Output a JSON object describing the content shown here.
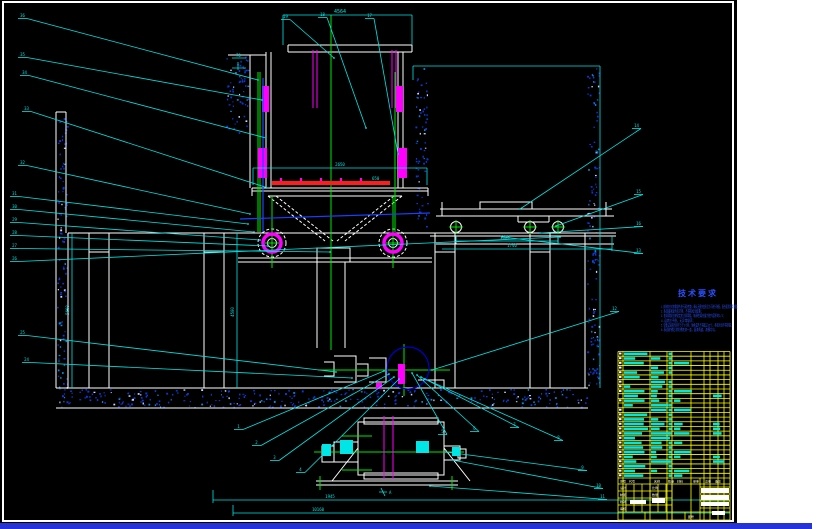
{
  "window": {
    "background": "#000000",
    "frame_color": "#ffffff",
    "margin_strip_color": "#ffffff",
    "bottom_bar_color": "#2633d8"
  },
  "palette": {
    "cyan": "#00e5e5",
    "green": "#00e800",
    "magenta": "#ff00ff",
    "red": "#ff1c1c",
    "yellow": "#ffff00",
    "hatch_blue": "#0a3ad4",
    "note_blue": "#2b50ff",
    "circle_blue": "#0000cc",
    "white": "#ffffff"
  },
  "dims": {
    "top": "4564",
    "trolley": "2650",
    "belt": "650",
    "side_a": "1125",
    "side_b": "1740",
    "bottom_a": "1945",
    "bottom_b": "10160",
    "pit_left": "5600",
    "pit_mid": "4500",
    "mini_a": "70",
    "section": "A"
  },
  "notes": {
    "title": "技术要求",
    "lines": [
      "1.安装前应对各零部件进行清洗检查，确认无损伤变形后方可进行装配，配合面涂润滑油脂；",
      "2.各连接紧固件应拧紧，不得有松动现象；",
      "3.各润滑部位按规定加注润滑脂，轴承腔填充量为腔内容积的2/3；",
      "4.运转应平稳，无异常噪声；",
      "5.空载试运转时间不少于2小时，轴承温升不得超过35℃，各密封处不得渗漏；",
      "6.表面除锈后涂防锈底漆一道，面漆两道，漆膜均匀。"
    ],
    "line_lengths": [
      78,
      42,
      64,
      34,
      72,
      56
    ]
  },
  "callouts": [
    {
      "n": "19",
      "lx": 283,
      "ly": 17,
      "tx": 334,
      "ty": 58
    },
    {
      "n": "18",
      "lx": 320,
      "ly": 15,
      "tx": 366,
      "ty": 128
    },
    {
      "n": "17",
      "lx": 367,
      "ly": 16,
      "tx": 398,
      "ty": 154
    },
    {
      "n": "36",
      "lx": 20,
      "ly": 16,
      "tx": 258,
      "ty": 80
    },
    {
      "n": "35",
      "lx": 20,
      "ly": 55,
      "tx": 262,
      "ty": 100
    },
    {
      "n": "34",
      "lx": 22,
      "ly": 73,
      "tx": 266,
      "ty": 138
    },
    {
      "n": "33",
      "lx": 24,
      "ly": 109,
      "tx": 268,
      "ty": 188
    },
    {
      "n": "32",
      "lx": 20,
      "ly": 163,
      "tx": 250,
      "ty": 214
    },
    {
      "n": "31",
      "lx": 12,
      "ly": 194,
      "tx": 248,
      "ty": 224
    },
    {
      "n": "30",
      "lx": 12,
      "ly": 207,
      "tx": 254,
      "ty": 232
    },
    {
      "n": "29",
      "lx": 12,
      "ly": 220,
      "tx": 260,
      "ty": 240
    },
    {
      "n": "28",
      "lx": 12,
      "ly": 233,
      "tx": 268,
      "ty": 246
    },
    {
      "n": "27",
      "lx": 12,
      "ly": 246,
      "tx": 330,
      "ty": 252
    },
    {
      "n": "26",
      "lx": 12,
      "ly": 259,
      "tx": 560,
      "ty": 237
    },
    {
      "n": "25",
      "lx": 20,
      "ly": 333,
      "tx": 336,
      "ty": 372
    },
    {
      "n": "24",
      "lx": 24,
      "ly": 360,
      "tx": 352,
      "ty": 378
    },
    {
      "n": "14",
      "lx": 634,
      "ly": 126,
      "tx": 520,
      "ty": 209
    },
    {
      "n": "15",
      "lx": 636,
      "ly": 192,
      "tx": 556,
      "ty": 226
    },
    {
      "n": "16",
      "lx": 636,
      "ly": 224,
      "tx": 540,
      "ty": 233
    },
    {
      "n": "13",
      "lx": 636,
      "ly": 251,
      "tx": 502,
      "ty": 237
    },
    {
      "n": "12",
      "lx": 612,
      "ly": 309,
      "tx": 432,
      "ty": 370
    },
    {
      "n": "1",
      "lx": 236,
      "ly": 427,
      "tx": 384,
      "ty": 371
    },
    {
      "n": "2",
      "lx": 254,
      "ly": 443,
      "tx": 389,
      "ty": 374
    },
    {
      "n": "3",
      "lx": 272,
      "ly": 458,
      "tx": 394,
      "ty": 377
    },
    {
      "n": "4",
      "lx": 298,
      "ly": 470,
      "tx": 399,
      "ty": 379
    },
    {
      "n": "5",
      "lx": 440,
      "ly": 432,
      "tx": 412,
      "ty": 373
    },
    {
      "n": "6",
      "lx": 472,
      "ly": 429,
      "tx": 417,
      "ty": 375
    },
    {
      "n": "7",
      "lx": 512,
      "ly": 425,
      "tx": 421,
      "ty": 377
    },
    {
      "n": "8",
      "lx": 556,
      "ly": 438,
      "tx": 425,
      "ty": 379
    },
    {
      "n": "9",
      "lx": 580,
      "ly": 468,
      "tx": 446,
      "ty": 452
    },
    {
      "n": "10",
      "lx": 596,
      "ly": 486,
      "tx": 452,
      "ty": 460
    },
    {
      "n": "11",
      "lx": 600,
      "ly": 497,
      "tx": 430,
      "ty": 486
    }
  ],
  "bom": {
    "rows": 27,
    "header": [
      "序号",
      "代号",
      "名称",
      "数量",
      "材料",
      "单重",
      "总重",
      "备注"
    ],
    "header_xs": [
      620,
      629,
      654,
      668,
      677,
      693,
      705,
      715
    ]
  },
  "title_block": {
    "labels": [
      {
        "t": "设计",
        "x": 620,
        "y": 489
      },
      {
        "t": "制图",
        "x": 620,
        "y": 496
      },
      {
        "t": "校对",
        "x": 620,
        "y": 503
      },
      {
        "t": "审核",
        "x": 620,
        "y": 510
      },
      {
        "t": "比例",
        "x": 652,
        "y": 489
      },
      {
        "t": "数量",
        "x": 652,
        "y": 496
      },
      {
        "t": "图号",
        "x": 688,
        "y": 518
      }
    ]
  }
}
